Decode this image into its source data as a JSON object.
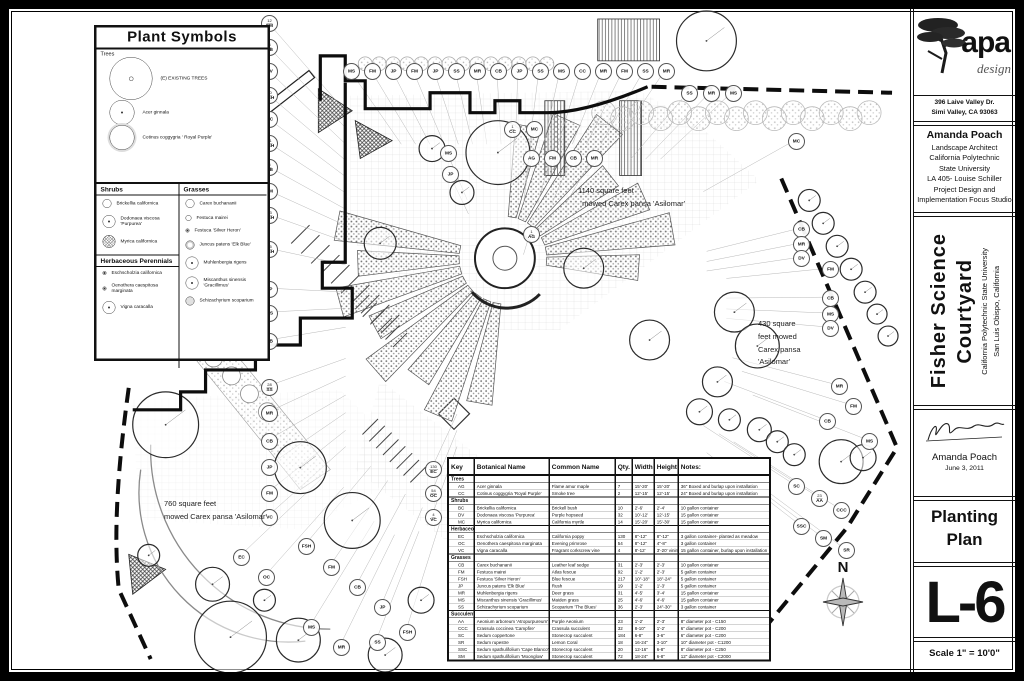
{
  "legend": {
    "title": "Plant Symbols",
    "sections": [
      {
        "label": "Trees",
        "items": [
          {
            "name": "(E) EXISTING TREES",
            "size": "xl",
            "fill": "target"
          },
          {
            "name": "Acer ginnala",
            "size": "lg",
            "fill": "dot"
          },
          {
            "name": "Cotinus coggygria ' Royal Purple'",
            "size": "lg",
            "fill": "halo"
          }
        ]
      },
      {
        "label": "Shrubs",
        "items": [
          {
            "name": "Brickellia californica",
            "size": "sm",
            "fill": "plain"
          },
          {
            "name": "Dodonaea viscosa 'Purpurea'",
            "size": "md",
            "fill": "dot"
          },
          {
            "name": "Myrica californica",
            "size": "md",
            "fill": "hatch"
          }
        ]
      },
      {
        "label": "Grasses",
        "items": [
          {
            "name": "Carex buchananii",
            "size": "sm",
            "fill": "plain"
          },
          {
            "name": "Festuca mairei",
            "size": "xs",
            "fill": "plain"
          },
          {
            "name": "Festuca 'Silver Heron'",
            "size": "xxs",
            "fill": "dot"
          },
          {
            "name": "Juncus patens 'Elk Blue'",
            "size": "sm",
            "fill": "gray"
          },
          {
            "name": "Muhlenbergia rigens",
            "size": "md",
            "fill": "dot"
          },
          {
            "name": "Miscanthus sinensis 'Gracillimus'",
            "size": "md",
            "fill": "dot"
          },
          {
            "name": "Schizachyrium scoparium",
            "size": "sm",
            "fill": "stipple"
          }
        ]
      },
      {
        "label": "Herbaceous Perennials",
        "items": [
          {
            "name": "Eschscholzia californica",
            "size": "xxs",
            "fill": "dot"
          },
          {
            "name": "Oenothera caespitosa marginata",
            "size": "xxs",
            "fill": "dot"
          },
          {
            "name": "Vigna caracalla",
            "size": "md",
            "fill": "dot"
          }
        ]
      }
    ]
  },
  "annotations": [
    {
      "x": 577,
      "y": 184,
      "lines": [
        "1140 square feet",
        "  mowed Carex pansa 'Asilomar'"
      ]
    },
    {
      "x": 757,
      "y": 317,
      "lines": [
        "430 square",
        "feet mowed",
        "Carex pansa",
        "'Asilomar'"
      ]
    },
    {
      "x": 163,
      "y": 497,
      "lines": [
        "760 square feet",
        "mowed Carex pansa 'Asilomar'"
      ]
    }
  ],
  "compass": {
    "label": "N"
  },
  "schedule": {
    "headers": [
      "Key",
      "Botanical Name",
      "Common Name",
      "Qty.",
      "Width",
      "Height",
      "Notes:"
    ],
    "groups": [
      {
        "label": "Trees",
        "rows": [
          [
            "AG",
            "Acer ginnala",
            "Flame amur maple",
            "7",
            "15'-20'",
            "15'-20'",
            "36\" Boxed and burlap upon installation"
          ],
          [
            "CC",
            "Cotinus coggygria 'Royal Purple'",
            "Smoke tree",
            "2",
            "12'-15'",
            "12'-15'",
            "24\" Boxed and burlap upon installation"
          ]
        ]
      },
      {
        "label": "Shrubs",
        "rows": [
          [
            "BC",
            "Brickellia californica",
            "Brickell bush",
            "10",
            "2'-6'",
            "2'-4'",
            "10 gallon container"
          ],
          [
            "DV",
            "Dodonaea viscosa 'Purpurea'",
            "Purple hopseed",
            "32",
            "10'-12'",
            "12'-15'",
            "15 gallon container"
          ],
          [
            "MC",
            "Myrica californica",
            "California myrtle",
            "14",
            "15'-20'",
            "15'-30'",
            "15 gallon container"
          ]
        ]
      },
      {
        "label": "Herbaceous Perennials",
        "rows": [
          [
            "EC",
            "Eschscholzia californica",
            "California poppy",
            "130",
            "8\"-12\"",
            "8\"-12\"",
            "3 gallon container- planted as meadow"
          ],
          [
            "OC",
            "Oenothera caespitosa marginata",
            "Evening primrose",
            "54",
            "8\"-12\"",
            "4\"-8\"",
            "3 gallon container"
          ],
          [
            "VC",
            "Vigna caracalla",
            "Fragrant corkscrew vine",
            "4",
            "8'-12'",
            "3'-20' vining",
            "15 gallon container, burlap upon installation"
          ]
        ]
      },
      {
        "label": "Grasses",
        "rows": [
          [
            "CB",
            "Carex buchananii",
            "Leather leaf sedge",
            "31",
            "2'-3'",
            "2'-3'",
            "10 gallon container"
          ],
          [
            "FM",
            "Festuca mairei",
            "Atlas fescue",
            "92",
            "1'-2'",
            "2'-3'",
            "5 gallon container"
          ],
          [
            "FSH",
            "Festuca 'Silver Heron'",
            "Blue fescue",
            "217",
            "10\"-18\"",
            "18\"-24\"",
            "5 gallon container"
          ],
          [
            "JP",
            "Juncus patens 'Elk Blue'",
            "Rush",
            "19",
            "1'-2'",
            "1'-3'",
            "5 gallon container"
          ],
          [
            "MR",
            "Muhlenbergia rigens",
            "Deer grass",
            "31",
            "4'-5'",
            "3'-4'",
            "15 gallon container"
          ],
          [
            "MS",
            "Miscanthus sinensis 'Gracillimus'",
            "Maiden grass",
            "25",
            "4'-6'",
            "4'-6'",
            "15 gallon container"
          ],
          [
            "SS",
            "Schizachyrium scoparium",
            "Scoparium 'The Blues'",
            "36",
            "2'-3'",
            "24\"-30\"",
            "3 gallon container"
          ]
        ]
      },
      {
        "label": "Succulents",
        "rows": [
          [
            "AA",
            "Aeonium arboreum 'Atropurpureum'",
            "Purple Aeonium",
            "23",
            "1'-2'",
            "2'-3'",
            "8\" diameter pot - C150"
          ],
          [
            "CCC",
            "Crassula coccinea 'Campfire'",
            "Crassula succulent",
            "32",
            "8-10\"",
            "1'-2'",
            "6\" diameter pot - C200"
          ],
          [
            "SC",
            "Sedum coppertone",
            "Stonecrop succulent",
            "184",
            "6-8\"",
            "3-6\"",
            "6\" diameter pot - C200"
          ],
          [
            "SR",
            "Sedum rupestre",
            "Lemon Coral",
            "18",
            "16-24\"",
            "3-10\"",
            "10\" diameter pot - C1200"
          ],
          [
            "SSC",
            "Sedum spathulifolium 'Cape Blanco'",
            "Stonecrop succulent",
            "20",
            "12-16\"",
            "6-8\"",
            "8\" diameter pot - C250"
          ],
          [
            "SM",
            "Sedum spathulifolium 'Moonglow'",
            "Stonecrop succulent",
            "72",
            "18-24\"",
            "6-8\"",
            "12\" diameter pot - C2000"
          ]
        ]
      }
    ]
  },
  "callouts": [
    {
      "x": 268,
      "y": 22,
      "c": "FM",
      "q": "12"
    },
    {
      "x": 268,
      "y": 46,
      "c": "CB",
      "q": "3"
    },
    {
      "x": 268,
      "y": 70,
      "c": "DV"
    },
    {
      "x": 268,
      "y": 94,
      "c": "FSH",
      "q": "10"
    },
    {
      "x": 268,
      "y": 118,
      "c": "MC"
    },
    {
      "x": 268,
      "y": 142,
      "c": "FSH",
      "q": "11"
    },
    {
      "x": 268,
      "y": 166,
      "c": "CB",
      "q": "5"
    },
    {
      "x": 268,
      "y": 190,
      "c": "FM"
    },
    {
      "x": 268,
      "y": 214,
      "c": "FSH",
      "q": "13"
    },
    {
      "x": 268,
      "y": 248,
      "c": "FSH",
      "q": "15"
    },
    {
      "x": 268,
      "y": 288,
      "c": "JP"
    },
    {
      "x": 268,
      "y": 312,
      "c": "MS"
    },
    {
      "x": 268,
      "y": 340,
      "c": "CB"
    },
    {
      "x": 268,
      "y": 386,
      "c": "SS",
      "q": "28"
    },
    {
      "x": 268,
      "y": 412,
      "c": "MR"
    },
    {
      "x": 268,
      "y": 440,
      "c": "CB"
    },
    {
      "x": 268,
      "y": 466,
      "c": "JP"
    },
    {
      "x": 268,
      "y": 492,
      "c": "FM"
    },
    {
      "x": 268,
      "y": 516,
      "c": "VC"
    },
    {
      "x": 350,
      "y": 70,
      "c": "MS"
    },
    {
      "x": 371,
      "y": 70,
      "c": "FM"
    },
    {
      "x": 392,
      "y": 70,
      "c": "JP"
    },
    {
      "x": 413,
      "y": 70,
      "c": "FM"
    },
    {
      "x": 434,
      "y": 70,
      "c": "JP"
    },
    {
      "x": 455,
      "y": 70,
      "c": "SS"
    },
    {
      "x": 476,
      "y": 70,
      "c": "MR"
    },
    {
      "x": 497,
      "y": 70,
      "c": "CB"
    },
    {
      "x": 518,
      "y": 70,
      "c": "JP"
    },
    {
      "x": 539,
      "y": 70,
      "c": "SS"
    },
    {
      "x": 560,
      "y": 70,
      "c": "MS"
    },
    {
      "x": 581,
      "y": 70,
      "c": "CC"
    },
    {
      "x": 602,
      "y": 70,
      "c": "MR"
    },
    {
      "x": 623,
      "y": 70,
      "c": "FM"
    },
    {
      "x": 644,
      "y": 70,
      "c": "SS"
    },
    {
      "x": 665,
      "y": 70,
      "c": "MR"
    },
    {
      "x": 688,
      "y": 92,
      "c": "SS"
    },
    {
      "x": 710,
      "y": 92,
      "c": "MR"
    },
    {
      "x": 732,
      "y": 92,
      "c": "MS"
    },
    {
      "x": 511,
      "y": 128,
      "c": "CC",
      "q": "1"
    },
    {
      "x": 533,
      "y": 128,
      "c": "MC"
    },
    {
      "x": 530,
      "y": 157,
      "c": "AG"
    },
    {
      "x": 551,
      "y": 157,
      "c": "FM"
    },
    {
      "x": 572,
      "y": 157,
      "c": "CB"
    },
    {
      "x": 593,
      "y": 157,
      "c": "MR"
    },
    {
      "x": 447,
      "y": 152,
      "c": "MS"
    },
    {
      "x": 449,
      "y": 173,
      "c": "JP"
    },
    {
      "x": 530,
      "y": 233,
      "c": "AG",
      "q": "1"
    },
    {
      "x": 800,
      "y": 228,
      "c": "CB"
    },
    {
      "x": 800,
      "y": 243,
      "c": "MR"
    },
    {
      "x": 800,
      "y": 257,
      "c": "DV"
    },
    {
      "x": 829,
      "y": 268,
      "c": "FM"
    },
    {
      "x": 829,
      "y": 297,
      "c": "CB"
    },
    {
      "x": 829,
      "y": 313,
      "c": "MS"
    },
    {
      "x": 829,
      "y": 327,
      "c": "DV"
    },
    {
      "x": 795,
      "y": 140,
      "c": "MC"
    },
    {
      "x": 838,
      "y": 385,
      "c": "MR"
    },
    {
      "x": 852,
      "y": 405,
      "c": "FM"
    },
    {
      "x": 826,
      "y": 420,
      "c": "CB"
    },
    {
      "x": 868,
      "y": 440,
      "c": "MS"
    },
    {
      "x": 795,
      "y": 485,
      "c": "SC"
    },
    {
      "x": 818,
      "y": 497,
      "c": "AA",
      "q": "23"
    },
    {
      "x": 840,
      "y": 509,
      "c": "CCC"
    },
    {
      "x": 800,
      "y": 525,
      "c": "SSC"
    },
    {
      "x": 822,
      "y": 537,
      "c": "SM"
    },
    {
      "x": 845,
      "y": 549,
      "c": "SR"
    },
    {
      "x": 432,
      "y": 468,
      "c": "EC",
      "q": "130"
    },
    {
      "x": 432,
      "y": 492,
      "c": "OC",
      "q": "54"
    },
    {
      "x": 432,
      "y": 516,
      "c": "VC",
      "q": "4"
    },
    {
      "x": 305,
      "y": 545,
      "c": "FSH"
    },
    {
      "x": 330,
      "y": 566,
      "c": "FM"
    },
    {
      "x": 356,
      "y": 586,
      "c": "CB"
    },
    {
      "x": 381,
      "y": 606,
      "c": "JP"
    },
    {
      "x": 310,
      "y": 626,
      "c": "MS"
    },
    {
      "x": 340,
      "y": 646,
      "c": "MR"
    },
    {
      "x": 376,
      "y": 641,
      "c": "SS"
    },
    {
      "x": 406,
      "y": 631,
      "c": "FSH"
    },
    {
      "x": 240,
      "y": 556,
      "c": "EC"
    },
    {
      "x": 265,
      "y": 576,
      "c": "OC"
    }
  ],
  "titleblock": {
    "brand": "apa",
    "brand_sub": "design",
    "address1": "396 Laive Valley Dr.",
    "address2": "Simi Valley, CA 93063",
    "designer_name": "Amanda Poach",
    "designer_lines": [
      "Landscape Architect",
      "California Polytechnic",
      "State University",
      "LA 405- Louise Schiller",
      "Project Design and",
      "Implementation Focus Studio"
    ],
    "project_title1": "Fisher Science",
    "project_title2": "Courtyard",
    "project_sub1": "California Polytechnic State University",
    "project_sub2": "San Luis Obispo, California",
    "signed_name": "Amanda Poach",
    "signed_date": "June 3, 2011",
    "sheet_title1": "Planting",
    "sheet_title2": "Plan",
    "sheet_number": "L-6",
    "scale": "Scale 1\" = 10'0\""
  }
}
